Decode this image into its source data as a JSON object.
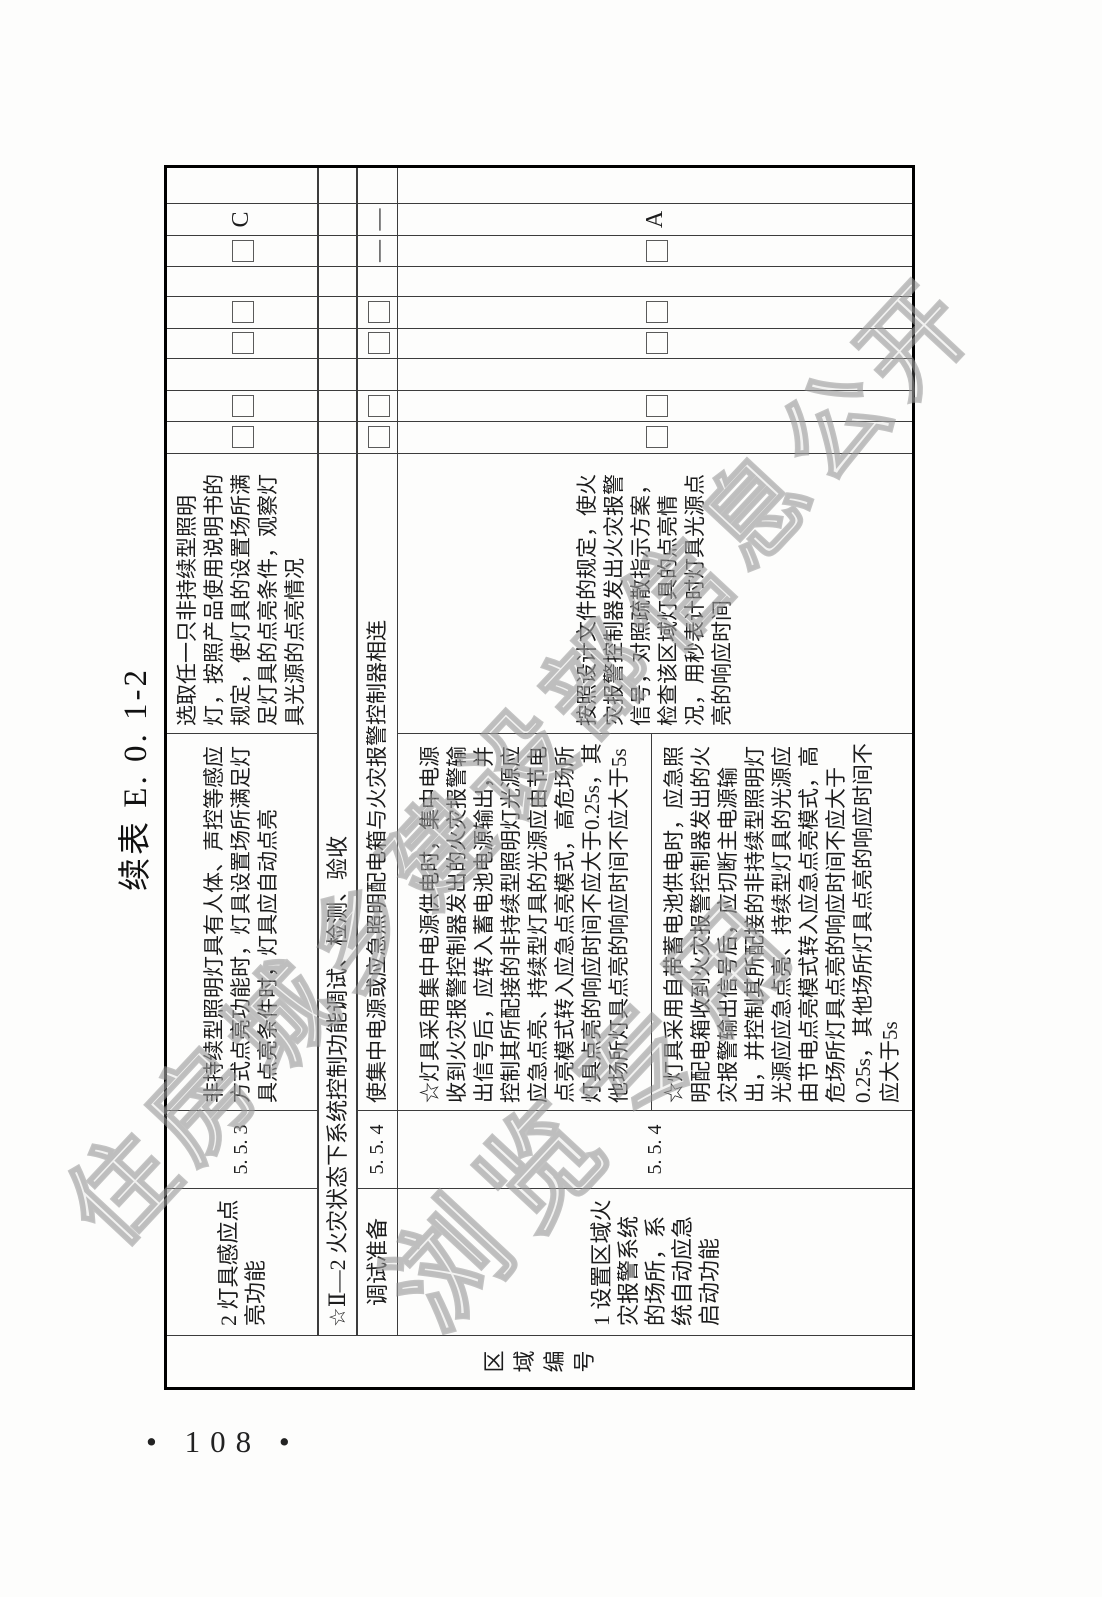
{
  "page": {
    "title": "续表 E. 0. 1-2",
    "page_number": "• 108 •"
  },
  "watermark": {
    "line1": "住房城乡建设部信息公开",
    "line2": "浏览专用",
    "color": "#ababab"
  },
  "table": {
    "region_header": "区域编号",
    "row_lamp_sensor": {
      "seq_item": "2 灯具感应点亮功能",
      "clause": "5. 5. 3",
      "requirement": "非持续型照明灯具有人体、声控等感应方式点亮功能时，灯具设置场所满足灯具点亮条件时，灯具应自动点亮",
      "method": "选取任一只非持续型照明灯，按照产品使用说明书的规定，使灯具的设置场所满足灯具的点亮条件，观察灯具光源的点亮情况",
      "grade": "C"
    },
    "section_header": "☆Ⅱ—2 火灾状态下系统控制功能调试、检测、验收",
    "row_debug_prep": {
      "item": "调试准备",
      "clause": "5. 5. 4",
      "content": "使集中电源或应急照明配电箱与火灾报警控制器相连",
      "dash": "—"
    },
    "row_fire_auto": {
      "seq_item": "1 设置区域火灾报警系统的场所，系统自动应急启动功能",
      "clause": "5. 5. 4",
      "requirement_centralized": "☆灯具采用集中电源供电时，集中电源收到火灾报警控制器发出的火灾报警输出信号后，应转入蓄电池电源输出，并控制其所配接的非持续型照明灯光源应应急点亮、持续型灯具的光源应由节电点亮模式转入应急点亮模式，高危场所灯具点亮的响应时间不应大于0.25s，其他场所灯具点亮的响应时间不应大于5s",
      "requirement_selfcontained": "☆灯具采用自带蓄电池供电时，应急照明配电箱收到火灾报警控制器发出的火灾报警输出信号后，应切断主电源输出，并控制其所配接的非持续型照明灯光源应应急点亮、持续型灯具的光源应由节电点亮模式转入应急点亮模式，高危场所灯具点亮的响应时间不应大于0.25s，其他场所灯具点亮的响应时间不应大于5s",
      "method": "按照设计文件的规定，使火灾报警控制器发出火灾报警信号，对照疏散指示方案，检查该区域灯具的点亮情况，用秒表计时灯具光源点亮的响应时间",
      "grade": "A"
    }
  }
}
